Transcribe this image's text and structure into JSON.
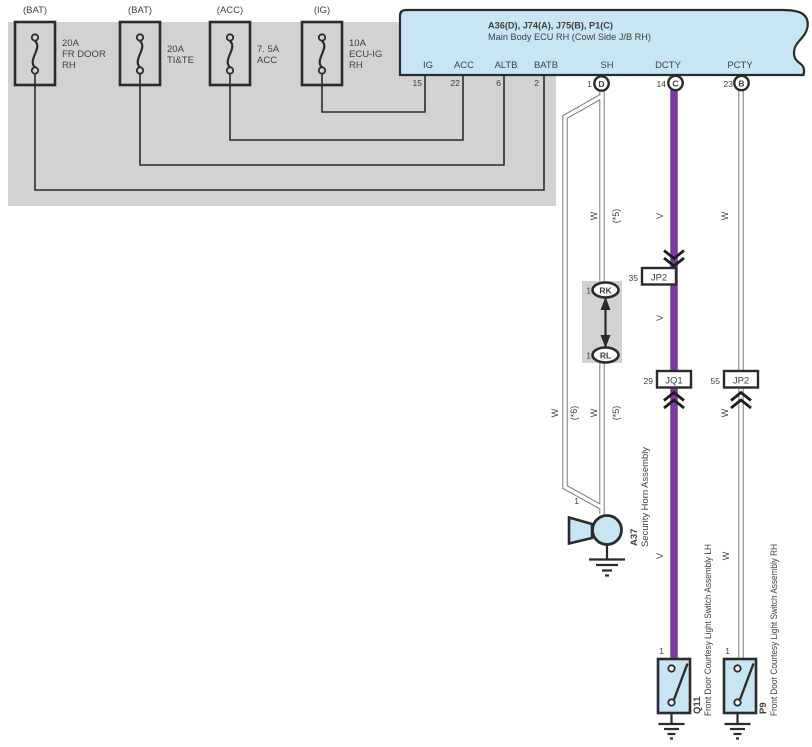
{
  "colors": {
    "panel_gray": "#d2d2d2",
    "component_blue": "#c8e5f4",
    "wire_violet": "#7c3b99",
    "wire_white_outline": "#7a7a7a",
    "line_black": "#2b2b2b"
  },
  "fuse_panel": {
    "fuses": [
      {
        "tag": "(BAT)",
        "line1": "20A",
        "line2": "FR DOOR",
        "line3": "RH"
      },
      {
        "tag": "(BAT)",
        "line1": "20A",
        "line2": "TI&TE",
        "line3": ""
      },
      {
        "tag": "(ACC)",
        "line1": "7. 5A",
        "line2": "ACC",
        "line3": ""
      },
      {
        "tag": "(IG)",
        "line1": "10A",
        "line2": "ECU-IG",
        "line3": "RH"
      }
    ]
  },
  "ecu": {
    "title": "A36(D), J74(A), J75(B), P1(C)",
    "subtitle": "Main Body ECU RH (Cowl Side J/B RH)",
    "pins": [
      {
        "label": "IG",
        "num": "15"
      },
      {
        "label": "ACC",
        "num": "22"
      },
      {
        "label": "ALTB",
        "num": "6"
      },
      {
        "label": "BATB",
        "num": "2"
      },
      {
        "label": "SH",
        "num": "1",
        "conn": "D"
      },
      {
        "label": "DCTY",
        "num": "14",
        "conn": "C"
      },
      {
        "label": "PCTY",
        "num": "23",
        "conn": "B"
      }
    ]
  },
  "wire_labels": {
    "white": "W",
    "violet": "V",
    "opt5": "(*5)",
    "opt6": "(*6)"
  },
  "inline_connectors": {
    "rk": {
      "pin": "1",
      "name": "RK"
    },
    "rl": {
      "pin": "1",
      "name": "RL"
    }
  },
  "junctions": [
    {
      "pin": "35",
      "name": "JP2"
    },
    {
      "pin": "29",
      "name": "JQ1"
    },
    {
      "pin": "55",
      "name": "JP2"
    }
  ],
  "components": {
    "horn": {
      "id": "A37",
      "pin": "1",
      "name": "Security Horn Assembly"
    },
    "door_switch_lh": {
      "id": "Q11",
      "pin": "1",
      "name": "Front Door Courtesy Light Switch Assembly LH"
    },
    "door_switch_rh": {
      "id": "P9",
      "pin": "1",
      "name": "Front Door Courtesy Light Switch Assembly RH"
    }
  }
}
